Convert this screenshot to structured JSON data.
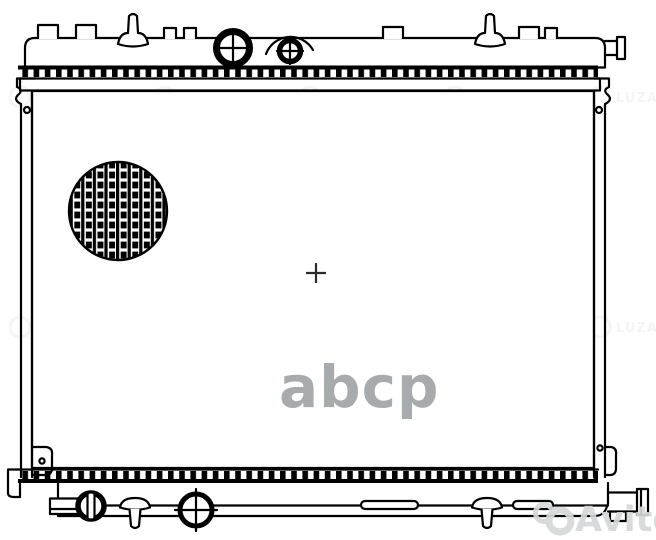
{
  "image": {
    "kind": "technical-line-drawing",
    "subject": "Automotive engine cooling radiator, front view",
    "background_color": "#ffffff",
    "line_color": "#000000",
    "center_mark": "+"
  },
  "watermarks": {
    "abcp": {
      "text": "abcp",
      "color": "#a8abae"
    },
    "avito": {
      "text": "Avito",
      "color": "#d5d7d8",
      "logo_icon": "avito-circles-icon"
    },
    "luzar": {
      "text": "LUZAR",
      "color": "#93999e",
      "logo_icon": "luzar-ring-icon"
    }
  }
}
